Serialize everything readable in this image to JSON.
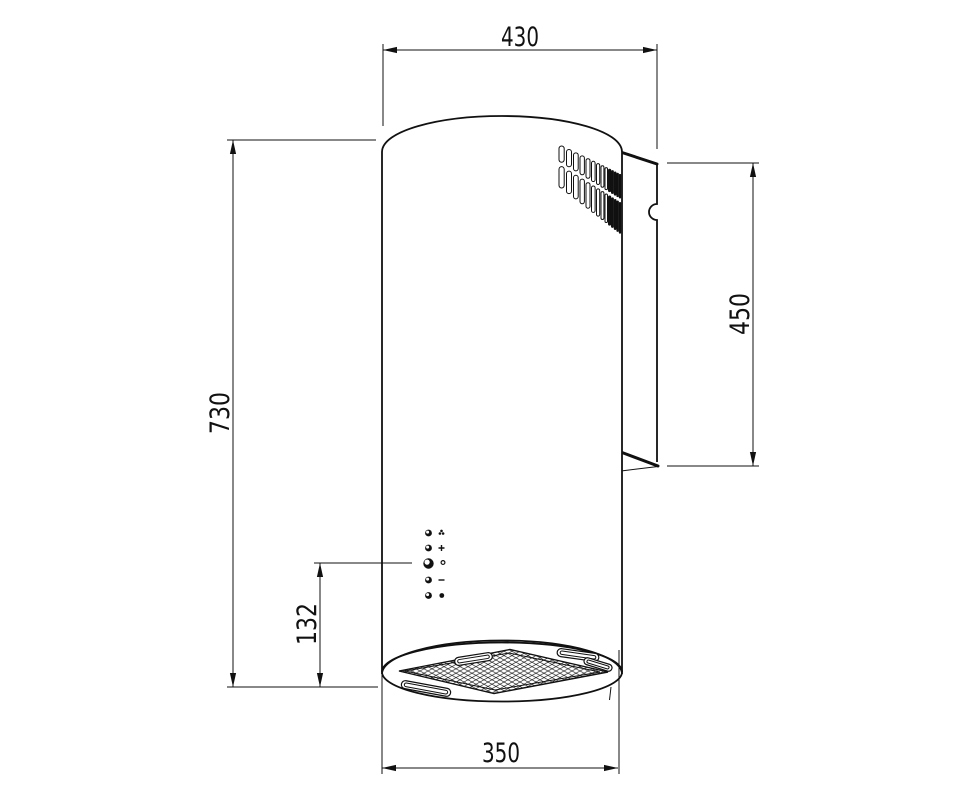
{
  "drawing": {
    "type": "technical-drawing",
    "subject": "cylindrical-wall-hood",
    "colors": {
      "line": "#111111",
      "background": "#ffffff"
    },
    "dimensions": {
      "total_depth_top": "430",
      "body_height_left": "730",
      "bracket_height_right": "450",
      "controls_offset_bottom": "132",
      "bottom_diameter": "350"
    },
    "controls": {
      "buttons": [
        {
          "icon": "fan-icon"
        },
        {
          "icon": "plus-icon"
        },
        {
          "icon": "indicator-icon"
        },
        {
          "icon": "minus-icon"
        },
        {
          "icon": "light-icon"
        }
      ]
    },
    "features": [
      "vent-grille-top",
      "wall-mounting-bracket",
      "control-button-column",
      "grease-filter-mesh-bottom"
    ]
  }
}
